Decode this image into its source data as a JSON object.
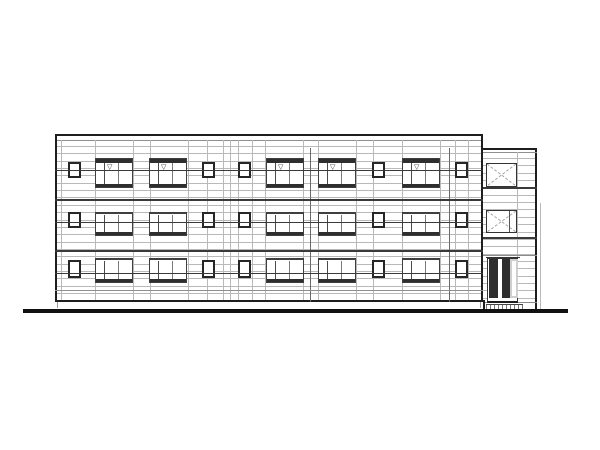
{
  "scene": {
    "width": 600,
    "height": 450,
    "background": "#ffffff",
    "title": "Front elevation line drawing of a three-story apartment building with right stair tower and entrance"
  },
  "colors": {
    "heavy": "#1e1e1e",
    "frame": "#262626",
    "frame2": "#3f3f3f",
    "medium": "#3a3a3a",
    "mid_gray": "#8f8f8f",
    "light": "#b9b9b9",
    "dark_fill": "#2e2e2e",
    "gray_fill": "#cfcfcf",
    "diag": "#9e9e9e",
    "ground": "#111111"
  },
  "ground": {
    "x": 23,
    "y": 309,
    "width": 545,
    "thickness": 3.5
  },
  "facade": {
    "x": 55,
    "y": 134,
    "width": 428,
    "height": 168,
    "parapet_inner_y": 140,
    "bottom_y": 300,
    "siding": {
      "start_y": 146,
      "end_y": 300,
      "spacing": 7.35
    },
    "vertical_joints": [
      61,
      95,
      133,
      150,
      188,
      207,
      223,
      230,
      238,
      252,
      265,
      303,
      318,
      356,
      373,
      402,
      440,
      455,
      468
    ],
    "medium_joints": [
      310,
      449
    ],
    "bands": [
      198.5,
      250
    ],
    "mid_band": 289.5,
    "level_lines": [
      169.5,
      221.5,
      272.5
    ],
    "plinth_ticks": [
      57,
      480
    ]
  },
  "windows": {
    "small": {
      "columns_x": [
        68,
        202,
        238,
        372,
        455
      ],
      "width": 13,
      "rows": [
        {
          "y": 162,
          "h": 16
        },
        {
          "y": 212,
          "h": 16
        },
        {
          "y": 260,
          "h": 18
        }
      ]
    },
    "large": {
      "columns_x": [
        95,
        149,
        266,
        318,
        402
      ],
      "width": 38,
      "side_panel_w": 8,
      "vent_symbol": "▽",
      "rows": [
        {
          "y": 158,
          "h": 30,
          "header": true,
          "vent": true
        },
        {
          "y": 212,
          "h": 24,
          "header": false,
          "vent": false
        },
        {
          "y": 258,
          "h": 25,
          "header": false,
          "vent": false
        }
      ]
    }
  },
  "annex": {
    "x": 483,
    "y": 148,
    "width": 54,
    "height": 161,
    "parapet_inner_y": 152,
    "siding": {
      "start_y": 158,
      "end_y": 302,
      "spacing": 7.35
    },
    "bands": [
      187,
      237
    ],
    "light_bands": [
      255,
      301.5
    ],
    "inner_vertical_x": 517,
    "outer_vertical": {
      "x": 540,
      "y1": 203,
      "y2": 309
    },
    "x_panels": [
      {
        "x": 486,
        "y": 163,
        "w": 31,
        "h": 24
      },
      {
        "x": 486,
        "y": 210,
        "w": 31,
        "h": 23,
        "extra_vertical_x": 508
      }
    ],
    "door": {
      "x": 487,
      "y": 258,
      "w": 31,
      "h": 45,
      "panels": [
        {
          "x": 1,
          "w": 9,
          "fill": "dark"
        },
        {
          "x": 10,
          "w": 4,
          "fill": "white"
        },
        {
          "x": 14,
          "w": 8,
          "fill": "dark"
        },
        {
          "x": 22,
          "w": 8,
          "fill": "gray"
        }
      ]
    },
    "step": {
      "x": 486,
      "y": 304,
      "w": 37,
      "h": 5
    }
  }
}
